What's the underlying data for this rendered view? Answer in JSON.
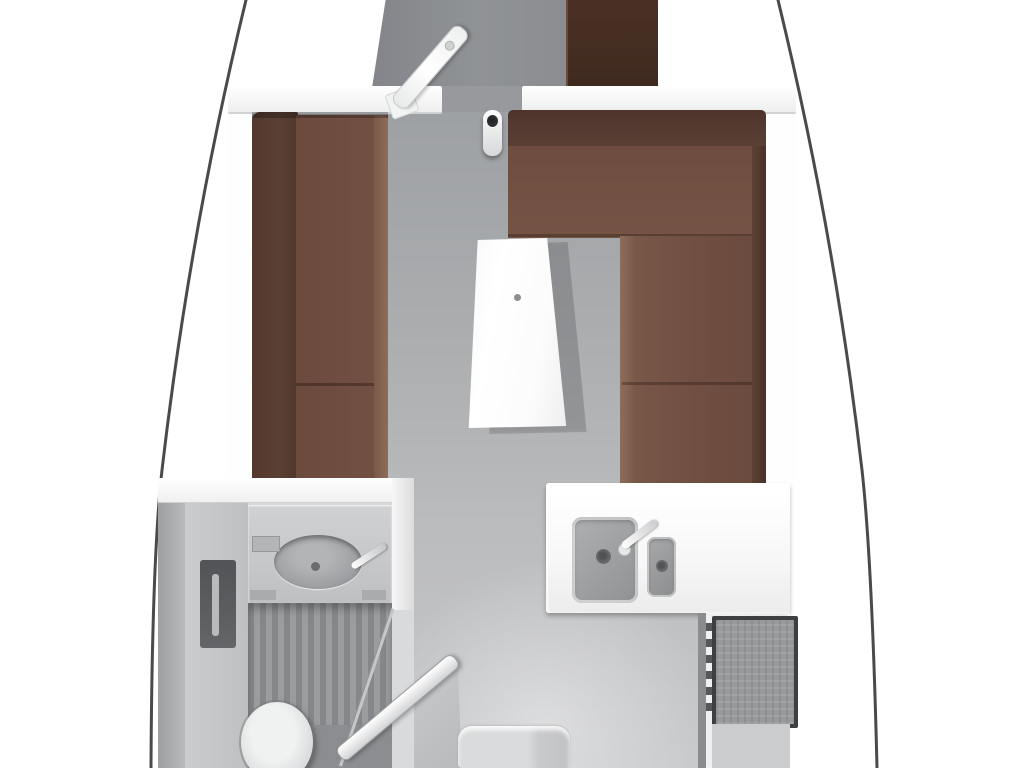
{
  "diagram": {
    "kind": "yacht-interior-floor-plan",
    "view": "top-down",
    "rooms": [
      "fore-cabin",
      "saloon",
      "head",
      "galley",
      "companionway"
    ]
  },
  "furniture": [
    "hull-outline",
    "fore-cabin-floor",
    "fore-cabin-wardrobe",
    "fore-cabin-door",
    "bulkhead",
    "mast-post",
    "port-settee",
    "starboard-settee",
    "saloon-table",
    "head-vanity",
    "head-basin",
    "head-faucet",
    "shower-grate",
    "toilet",
    "head-door",
    "galley-counter",
    "galley-sink-large",
    "galley-sink-small",
    "galley-faucet",
    "stove-oven",
    "companionway-step"
  ],
  "colors": {
    "hull_line": "#4a4a4a",
    "deck_white": "#ffffff",
    "doorway_gray": "#97999c",
    "floor_gray_top": "#9da0a3",
    "floor_gray_bottom": "#c8c9cb",
    "wardrobe_brown": "#4a3024",
    "upholstery_backrest": "#5a4035",
    "upholstery_seat": "#725043",
    "upholstery_light": "#8d6c5a",
    "table_white": "#ffffff",
    "mast_dark": "#3a3b3c",
    "counter_white": "#f7f7f8",
    "sink_steel": "#8f9193",
    "stove_frame": "#3e3f41",
    "stove_body": "#97999b",
    "vanity_counter": "#bfc0c2",
    "basin_gray": "#9b9da0",
    "shower_slat_dark": "#85878a",
    "shower_slat_light": "#9a9c9e",
    "toilet_white": "#f0f1f1",
    "recess_dark": "#636568",
    "door_white": "#ffffff",
    "step_gray": "#dadbdc",
    "side_shadow": "#8a8c8e"
  }
}
